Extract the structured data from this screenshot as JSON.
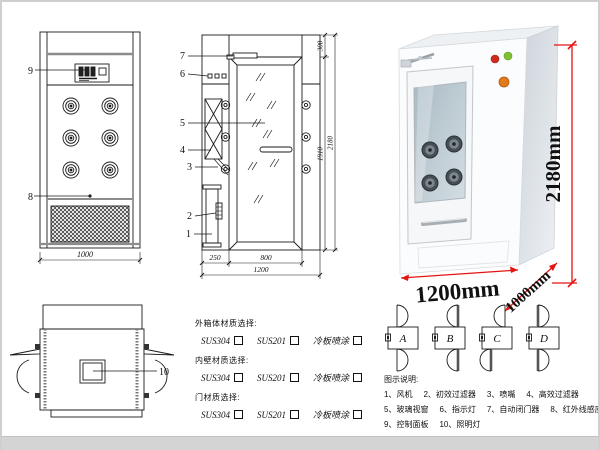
{
  "drawing": {
    "front_view": {
      "callouts": {
        "control_panel": "9",
        "grille": "8"
      },
      "width_dim": "1000"
    },
    "side_view": {
      "callouts": [
        "7",
        "6",
        "5",
        "4",
        "3",
        "2",
        "1"
      ],
      "dims": {
        "top": "300",
        "door_h": "1910",
        "total_h": "2180",
        "left_w": "250",
        "door_w": "800",
        "total_w": "1200"
      }
    },
    "top_view": {
      "callouts": {
        "light": "10"
      }
    }
  },
  "photo": {
    "dims": {
      "height": "2180mm",
      "width": "1200mm",
      "depth": "1000mm"
    },
    "dim_color": "#e41410",
    "indicator_colors": {
      "red": "#cc2b1f",
      "green": "#7fc133",
      "orange": "#e2791b"
    }
  },
  "materials": {
    "groups": [
      {
        "title": "外箱体材质选择:",
        "options": [
          "SUS304",
          "SUS201",
          "冷板喷涂"
        ]
      },
      {
        "title": "内壁材质选择:",
        "options": [
          "SUS304",
          "SUS201",
          "冷板喷涂"
        ]
      },
      {
        "title": "门材质选择:",
        "options": [
          "SUS304",
          "SUS201",
          "冷板喷涂"
        ]
      }
    ]
  },
  "door_options": {
    "labels": [
      "A",
      "B",
      "C",
      "D"
    ]
  },
  "legend": {
    "title": "图示说明:",
    "rows": [
      [
        "1、风机",
        "2、初效过滤器",
        "3、喷嘴",
        "4、高效过滤器"
      ],
      [
        "5、玻璃视窗",
        "6、指示灯",
        "7、自动闭门器",
        "8、红外线感应器"
      ],
      [
        "9、控制面板",
        "10、照明灯"
      ]
    ]
  }
}
